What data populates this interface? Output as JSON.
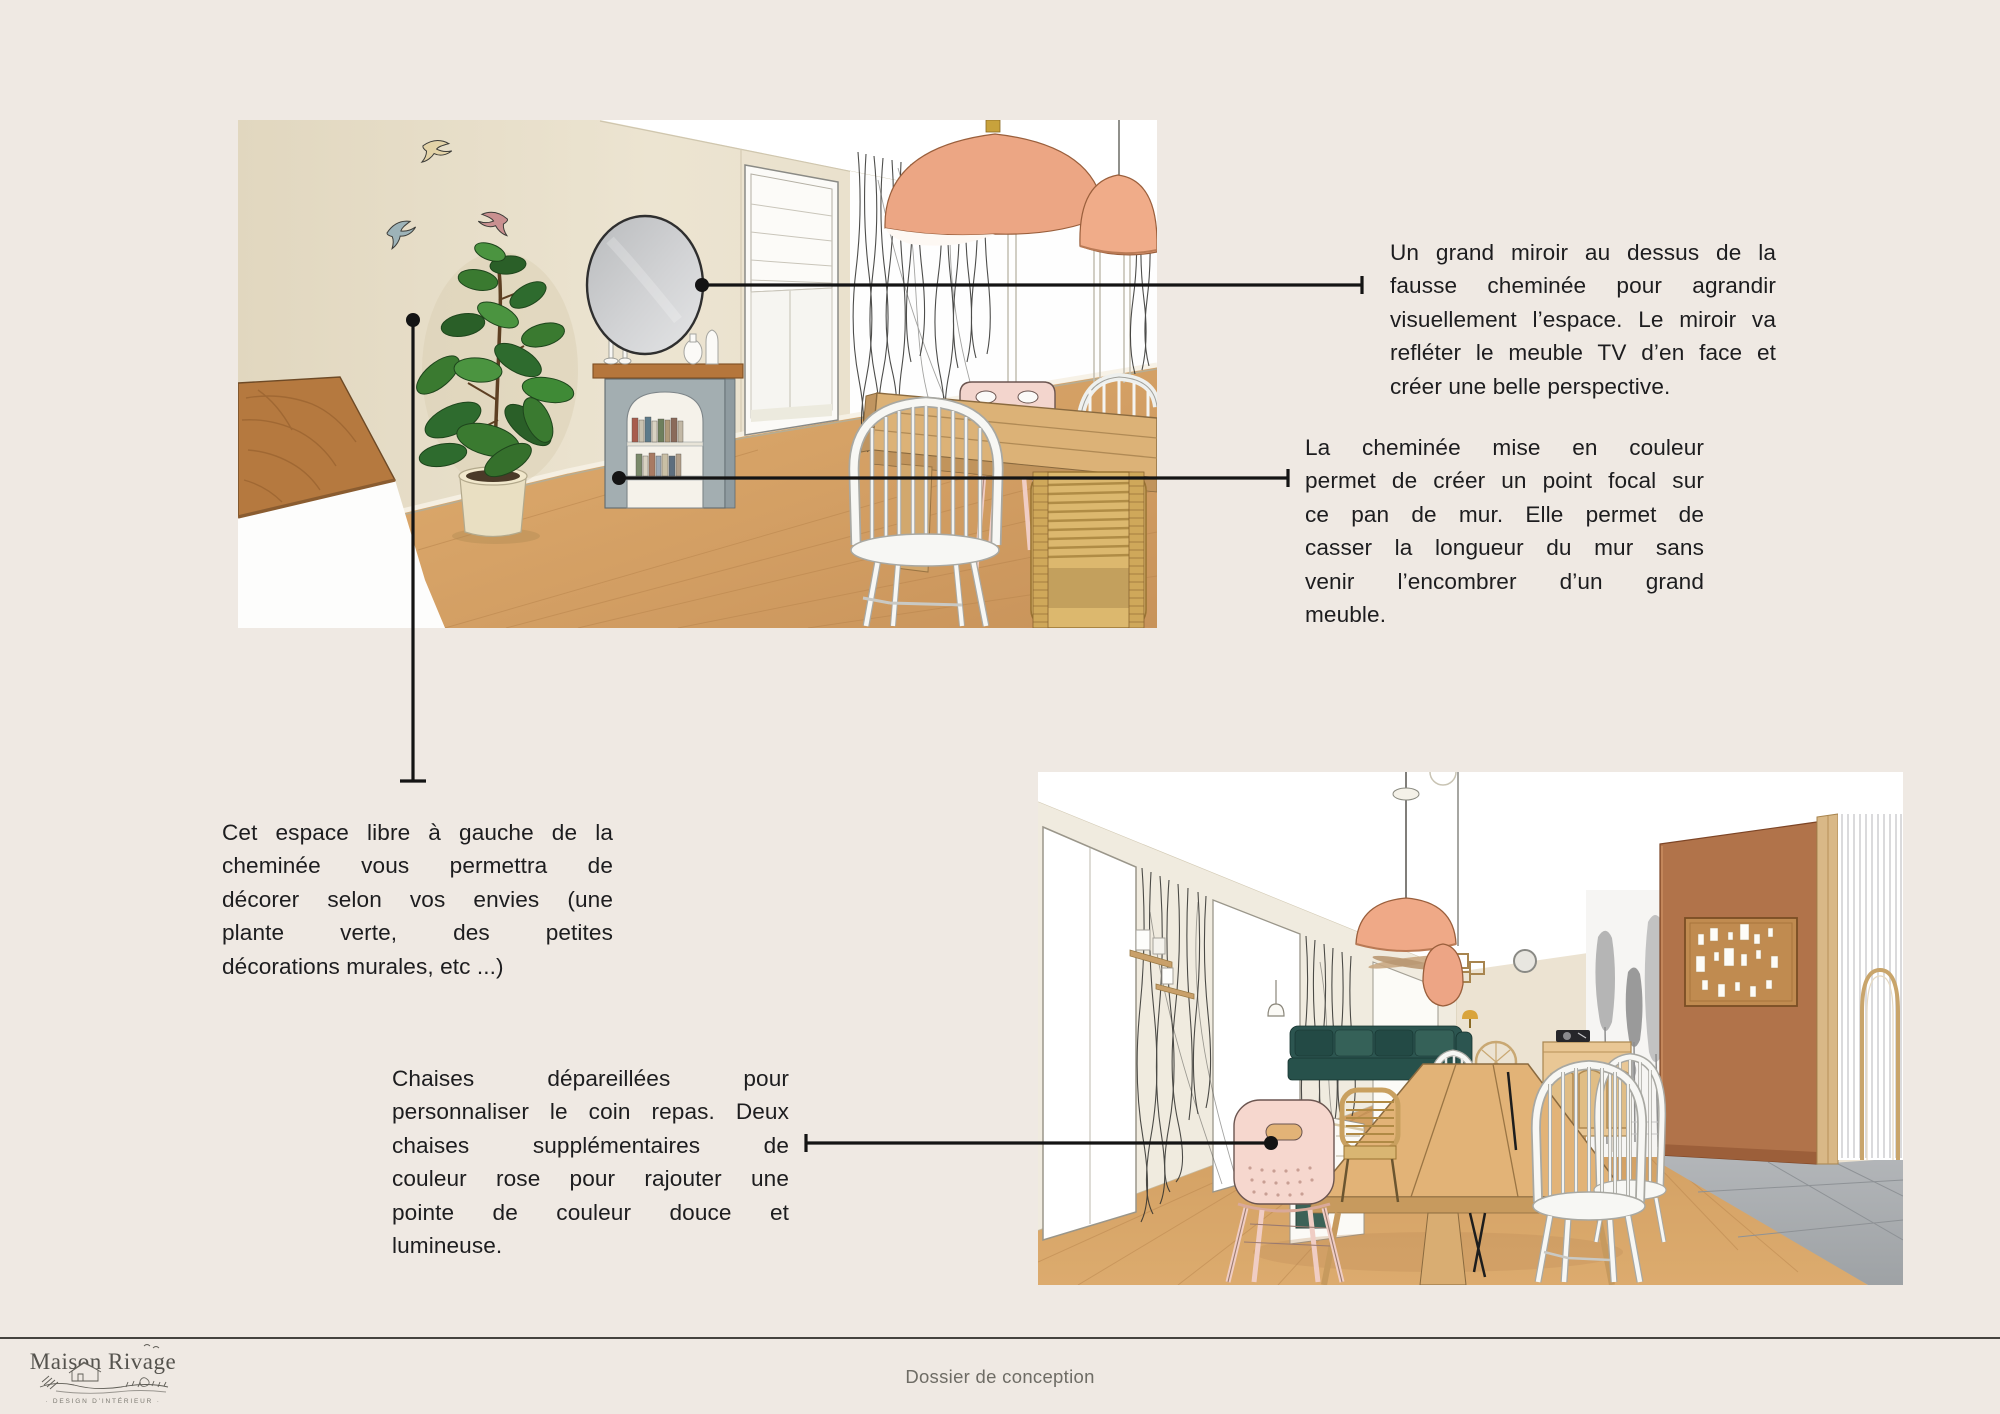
{
  "annotations": {
    "mirror_note": {
      "lines": [
        "Un grand miroir au dessus de la",
        "fausse cheminée pour agrandir",
        "visuellement l’espace. Le miroir va",
        "refléter le meuble TV d’en face et",
        "créer une belle perspective."
      ]
    },
    "fireplace_note": {
      "lines": [
        "La cheminée mise en couleur",
        "permet de créer un point focal sur",
        "ce pan de mur. Elle permet de",
        "casser la longueur du mur sans",
        "venir l’encombrer d’un grand",
        "meuble."
      ]
    },
    "free_space_note": {
      "lines": [
        "Cet espace libre à gauche de la",
        "cheminée vous permettra de",
        "décorer selon vos envies (une",
        "plante verte, des petites",
        "décorations murales, etc ...)"
      ]
    },
    "chairs_note": {
      "lines": [
        "Chaises dépareillées pour",
        "personnaliser le coin repas. Deux",
        "chaises supplémentaires de",
        "couleur rose pour rajouter une",
        "pointe de couleur douce et",
        "lumineuse."
      ]
    }
  },
  "footer": {
    "brand": "Maison Rivage",
    "brand_tagline": "· DESIGN D’INTÉRIEUR ·",
    "document_title": "Dossier de conception"
  },
  "colors": {
    "background": "#EFE9E3",
    "text": "#1D1D1F",
    "connector": "#141414",
    "muted_text": "#6E6C65",
    "wall_cream": "#E9E1CD",
    "wood_floor": "#D9A869",
    "terracotta_wall": "#B1734A",
    "peach_lamp": "#EFA987",
    "fireplace_blue_gray": "#A3AEB1",
    "sofa_teal": "#2D544E",
    "chair_pink": "#F5D5CC"
  }
}
